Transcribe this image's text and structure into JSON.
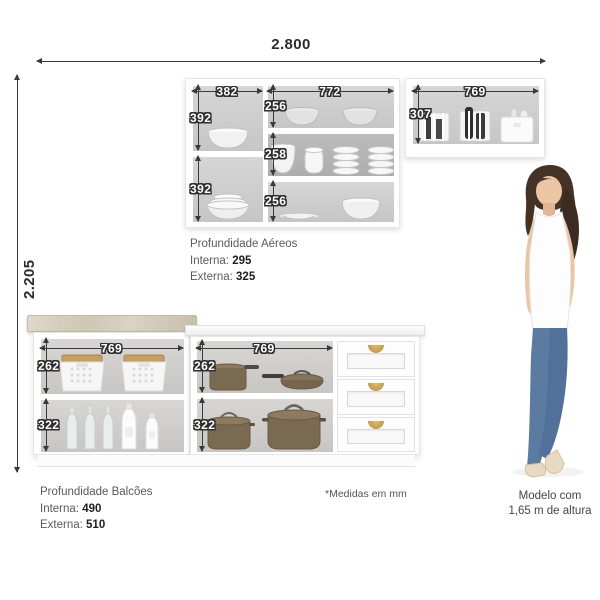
{
  "overall": {
    "width": "2.800",
    "height": "2.205"
  },
  "upper_cabinets": {
    "depth_title": "Profundidade Aéreos",
    "interna_label": "Interna:",
    "interna_value": "295",
    "externa_label": "Externa:",
    "externa_value": "325",
    "left_section": {
      "width": "382",
      "shelves": [
        "392",
        "392"
      ]
    },
    "center_section": {
      "width": "772",
      "shelves": [
        "256",
        "258",
        "256"
      ]
    },
    "right_section": {
      "width": "769",
      "shelves": [
        "307"
      ]
    }
  },
  "lower_cabinets": {
    "depth_title": "Profundidade Balcões",
    "interna_label": "Interna:",
    "interna_value": "490",
    "externa_label": "Externa:",
    "externa_value": "510",
    "left_section": {
      "width": "769",
      "shelves": [
        "262",
        "322"
      ]
    },
    "center_section": {
      "width": "769",
      "shelves": [
        "262",
        "322"
      ]
    }
  },
  "notes": {
    "units": "*Medidas em mm"
  },
  "model_caption": {
    "line1": "Modelo com",
    "line2": "1,65 m de altura"
  },
  "colors": {
    "dimension_line": "#3a3a3a",
    "cabinet_interior": "#cccccc",
    "countertop_beige": "#d6cdbc",
    "wood_lid": "#c79e62",
    "pot_brown": "#7b6a52",
    "handle_gold": "#c7a04c",
    "jeans_blue": "#5b7ba0"
  }
}
